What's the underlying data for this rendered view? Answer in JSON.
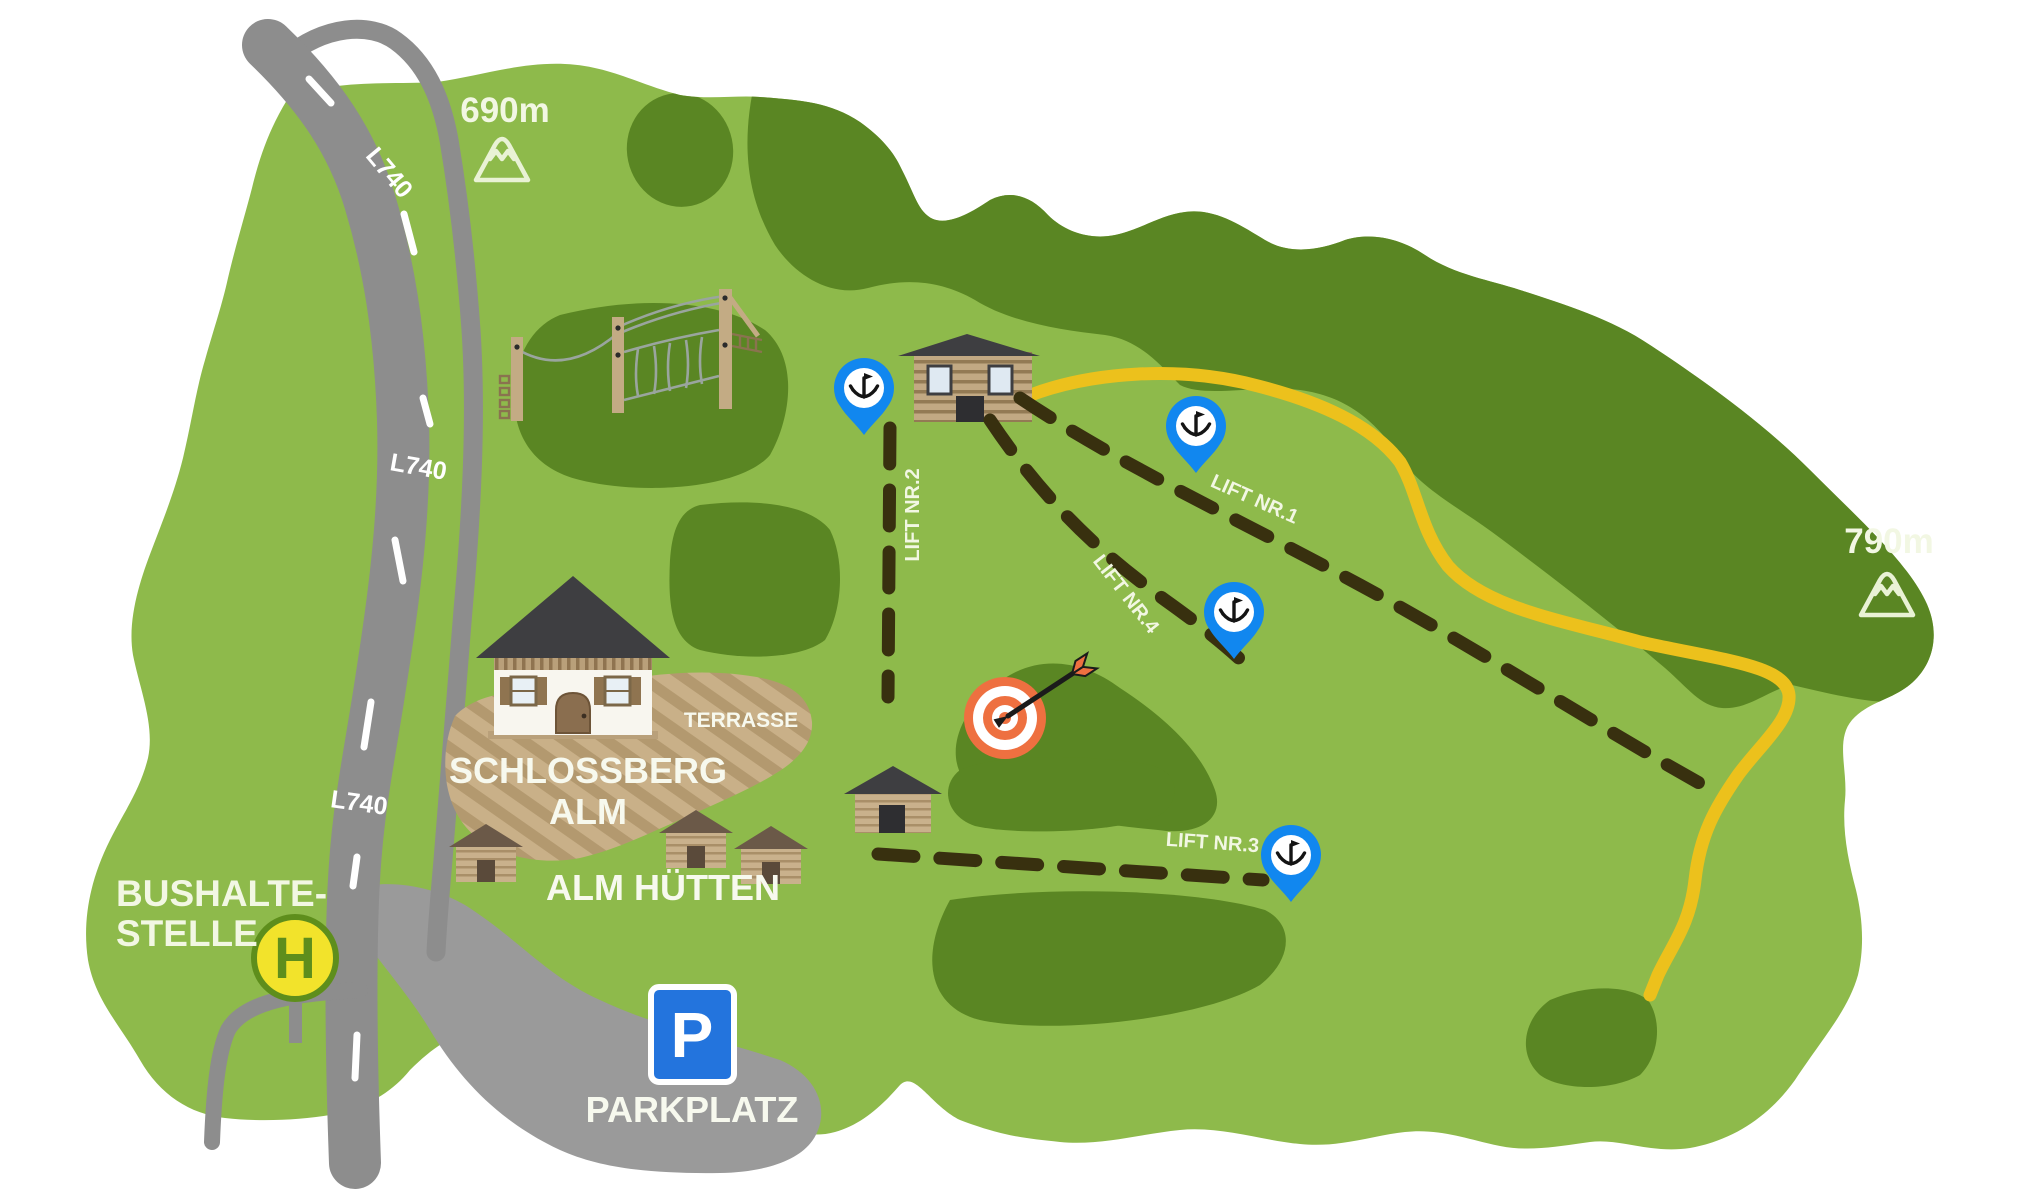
{
  "labels": {
    "elevation_top": "690m",
    "elevation_right": "790m",
    "road_name": "L740",
    "bus_stop_line1": "BUSHALTE-",
    "bus_stop_line2": "STELLE",
    "bus_stop_symbol": "H",
    "parking_name": "PARKPLATZ",
    "parking_symbol": "P",
    "alm_name_line1": "SCHLOSSBERG",
    "alm_name_line2": "ALM",
    "terrace": "TERRASSE",
    "huts_label": "ALM HÜTTEN",
    "lift1": "LIFT NR.1",
    "lift2": "LIFT NR.2",
    "lift3": "LIFT NR.3",
    "lift4": "LIFT NR.4"
  },
  "icons": {
    "lift_station_marker": "anchor-icon",
    "summit_marker": "mountain-icon",
    "archery": "target-with-arrow-icon",
    "bus_stop": "h-sign-icon",
    "parking": "p-sign-icon"
  },
  "colors": {
    "meadow_green": "#8eba4b",
    "forest_green": "#5a8623",
    "road_gray": "#8d8d8d",
    "parking_gray": "#9a9a9a",
    "trail_yellow": "#ecc11c",
    "lift_line_brown": "#38300f",
    "marker_blue": "#1187ef",
    "target_orange": "#ee7040",
    "bus_stop_yellow": "#f2e32b",
    "bus_stop_green": "#5e8e1c",
    "parking_blue": "#2374dd",
    "wood_tan": "#c7ae85",
    "roof_dark": "#3e3e41",
    "roof_brown": "#6b5948",
    "label_white": "#f2f7e3"
  }
}
